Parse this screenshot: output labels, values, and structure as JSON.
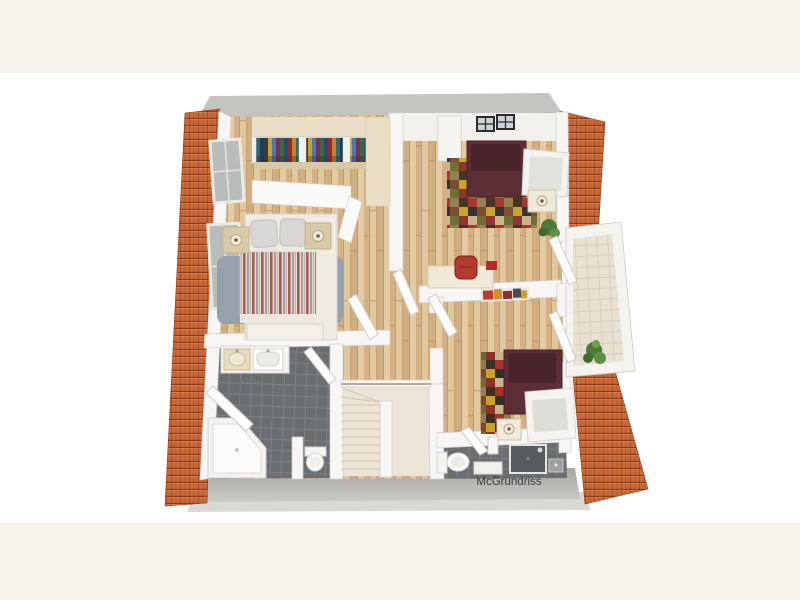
{
  "watermark": {
    "text": "McGrundriss"
  },
  "palette": {
    "page_band": "#f7f3ec",
    "photo_bg": "#ffffff",
    "roof_tile": "#c8693a",
    "outer_wall": "#c6c4c1",
    "outer_wall_dark": "#aeaca9",
    "outer_wall_light": "#dbd9d6",
    "inner_wall": "#f7f6f4",
    "wood_floor": "#d9ba8e",
    "ceiling_beige": "#eadfc6",
    "bath_tile": "#6a6e71",
    "stairs": "#ece4d6",
    "balcony_tile": "#e9e2d2",
    "bed_maroon": "#5c2e36",
    "rug_blue": "#97a1ae",
    "stripe_red": "#a65a54",
    "chair_red": "#b23a2e",
    "plant_green": "#4c7a38",
    "lamp_beige": "#d8c9a8",
    "text_color": "#3c3c3c"
  }
}
